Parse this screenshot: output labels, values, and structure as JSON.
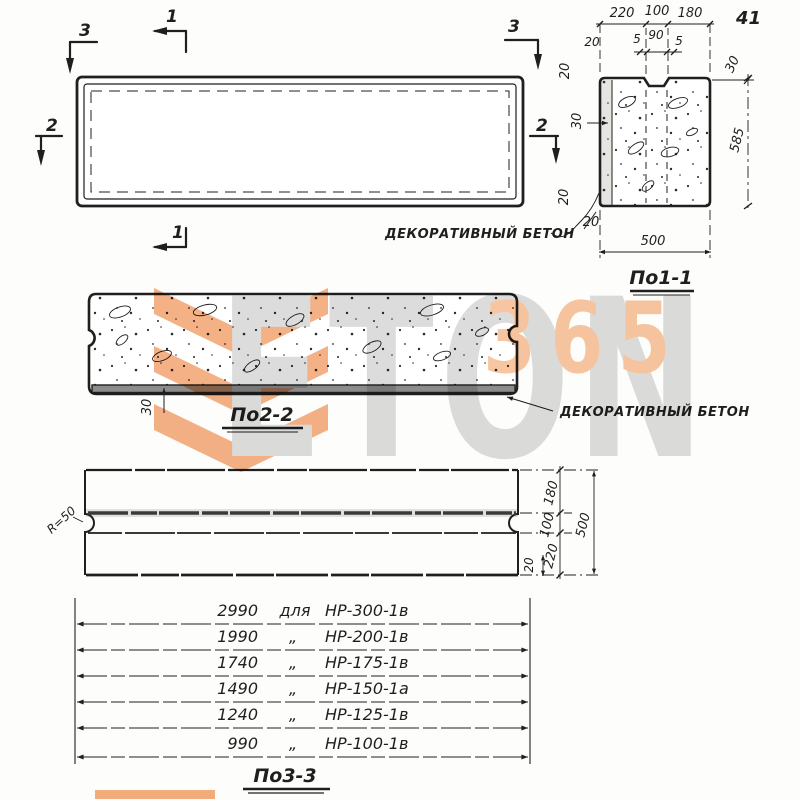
{
  "page_number": "41",
  "ink_color": "#1f1f1f",
  "watermark": {
    "word": "ETON",
    "number": "365",
    "orange": "#f2a470",
    "light_orange": "#f7c6a0",
    "gray": "#dcdcdc"
  },
  "plan_view": {
    "marker_1": "1",
    "marker_2": "2",
    "marker_3": "3"
  },
  "section_1": {
    "title": "По1-1",
    "top_dims": [
      "220",
      "100",
      "180"
    ],
    "groove_left": "20",
    "groove_dims": [
      "5",
      "90",
      "5"
    ],
    "notch_depth": "30",
    "left_top": "20",
    "left_mid": "30",
    "left_bottom": "20",
    "bottom_left": "20",
    "height": "585",
    "width": "500",
    "note": "ДЕКОРАТИВНЫЙ БЕТОН"
  },
  "section_2": {
    "title": "По2-2",
    "base_thickness": "30",
    "note": "ДЕКОРАТИВНЫЙ БЕТОН"
  },
  "section_3": {
    "title": "По3-3",
    "radius": "R=50",
    "right_dims": [
      "180",
      "100",
      "220"
    ],
    "total_height": "500",
    "edge_offset": "20",
    "table": [
      {
        "len": "2990",
        "sep": "для",
        "mark": "НР-300-1в"
      },
      {
        "len": "1990",
        "sep": "„",
        "mark": "НР-200-1в"
      },
      {
        "len": "1740",
        "sep": "„",
        "mark": "НР-175-1в"
      },
      {
        "len": "1490",
        "sep": "„",
        "mark": "НР-150-1а"
      },
      {
        "len": "1240",
        "sep": "„",
        "mark": "НР-125-1в"
      },
      {
        "len": "990",
        "sep": "„",
        "mark": "НР-100-1в"
      }
    ]
  }
}
